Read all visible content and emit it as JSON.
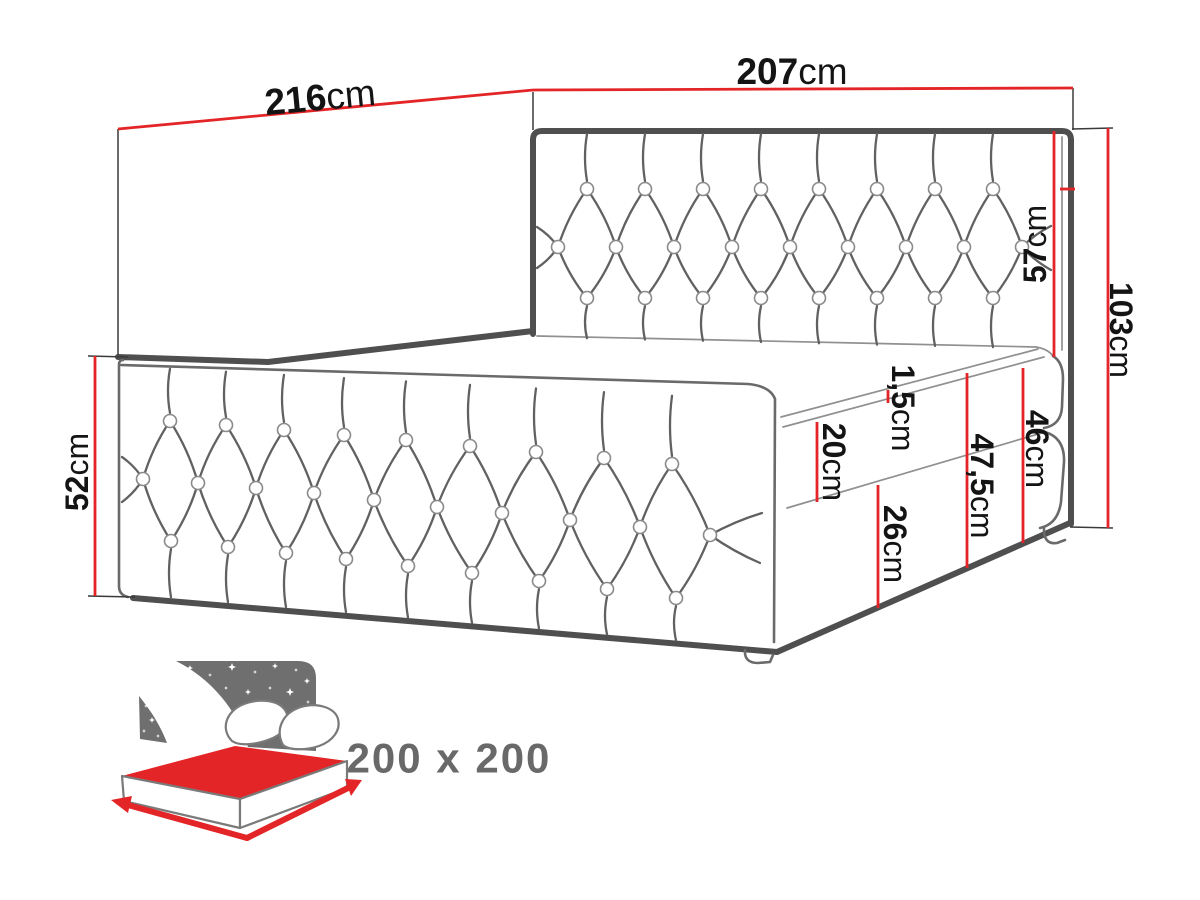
{
  "dimensions": {
    "frame_length": {
      "num": "216",
      "unit": "cm"
    },
    "frame_width": {
      "num": "207",
      "unit": "cm"
    },
    "headboard_height": {
      "num": "57",
      "unit": "cm"
    },
    "total_height": {
      "num": "103",
      "unit": "cm"
    },
    "side_panel_height": {
      "num": "52",
      "unit": "cm"
    },
    "topper_thickness": {
      "num": "1,5",
      "unit": "cm"
    },
    "mattress_thickness": {
      "num": "20",
      "unit": "cm"
    },
    "entry_height": {
      "num": "47,5",
      "unit": "cm"
    },
    "mattress_with_box": {
      "num": "46",
      "unit": "cm"
    },
    "box_height": {
      "num": "26",
      "unit": "cm"
    }
  },
  "size_badge": {
    "label": "200 x 200"
  },
  "colors": {
    "dimension_red": "#e42527",
    "outline_dark": "#4f4f4f",
    "outline_medium": "#6a6a6a",
    "outline_light": "#909090",
    "icon_gray": "#6f6f6f",
    "label_black": "#141414",
    "size_text_gray": "#696969"
  }
}
